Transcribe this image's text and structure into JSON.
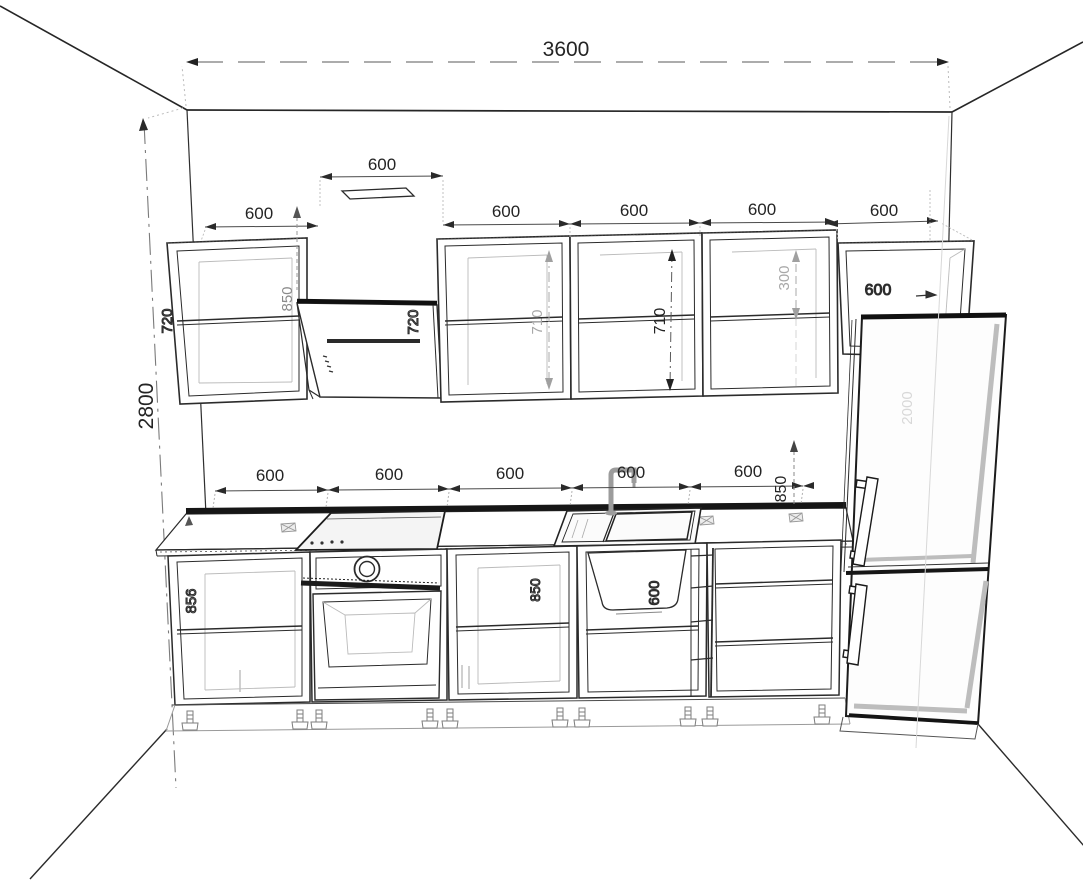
{
  "drawing_type": "kitchen-elevation-wireframe",
  "colors": {
    "line": "#2b2b2b",
    "dark": "#141414",
    "grey": "#9a9a9a",
    "faint": "#d0d0d0",
    "background": "#ffffff"
  },
  "dims": {
    "wall_width": "3600",
    "wall_height": "2800",
    "upper": {
      "cab1_w": "600",
      "hood_w": "600",
      "cab2_w": "600",
      "cab3_w": "600",
      "cab4_w": "600",
      "fridge_cab_w": "600",
      "cab1_h": "720",
      "hood_h": "720",
      "cab2_h": "710",
      "cab3_h": "710",
      "fridge_cab_h": "300",
      "fridge_cab_d": "600",
      "hood_clearance": "850"
    },
    "base": {
      "w1": "600",
      "w2": "600",
      "w3": "600",
      "w4": "600",
      "w5": "600",
      "counter_height": "850",
      "carcass_height": "856",
      "sink_w": "600",
      "mid_faint": "850"
    },
    "fridge_h": "2000"
  }
}
